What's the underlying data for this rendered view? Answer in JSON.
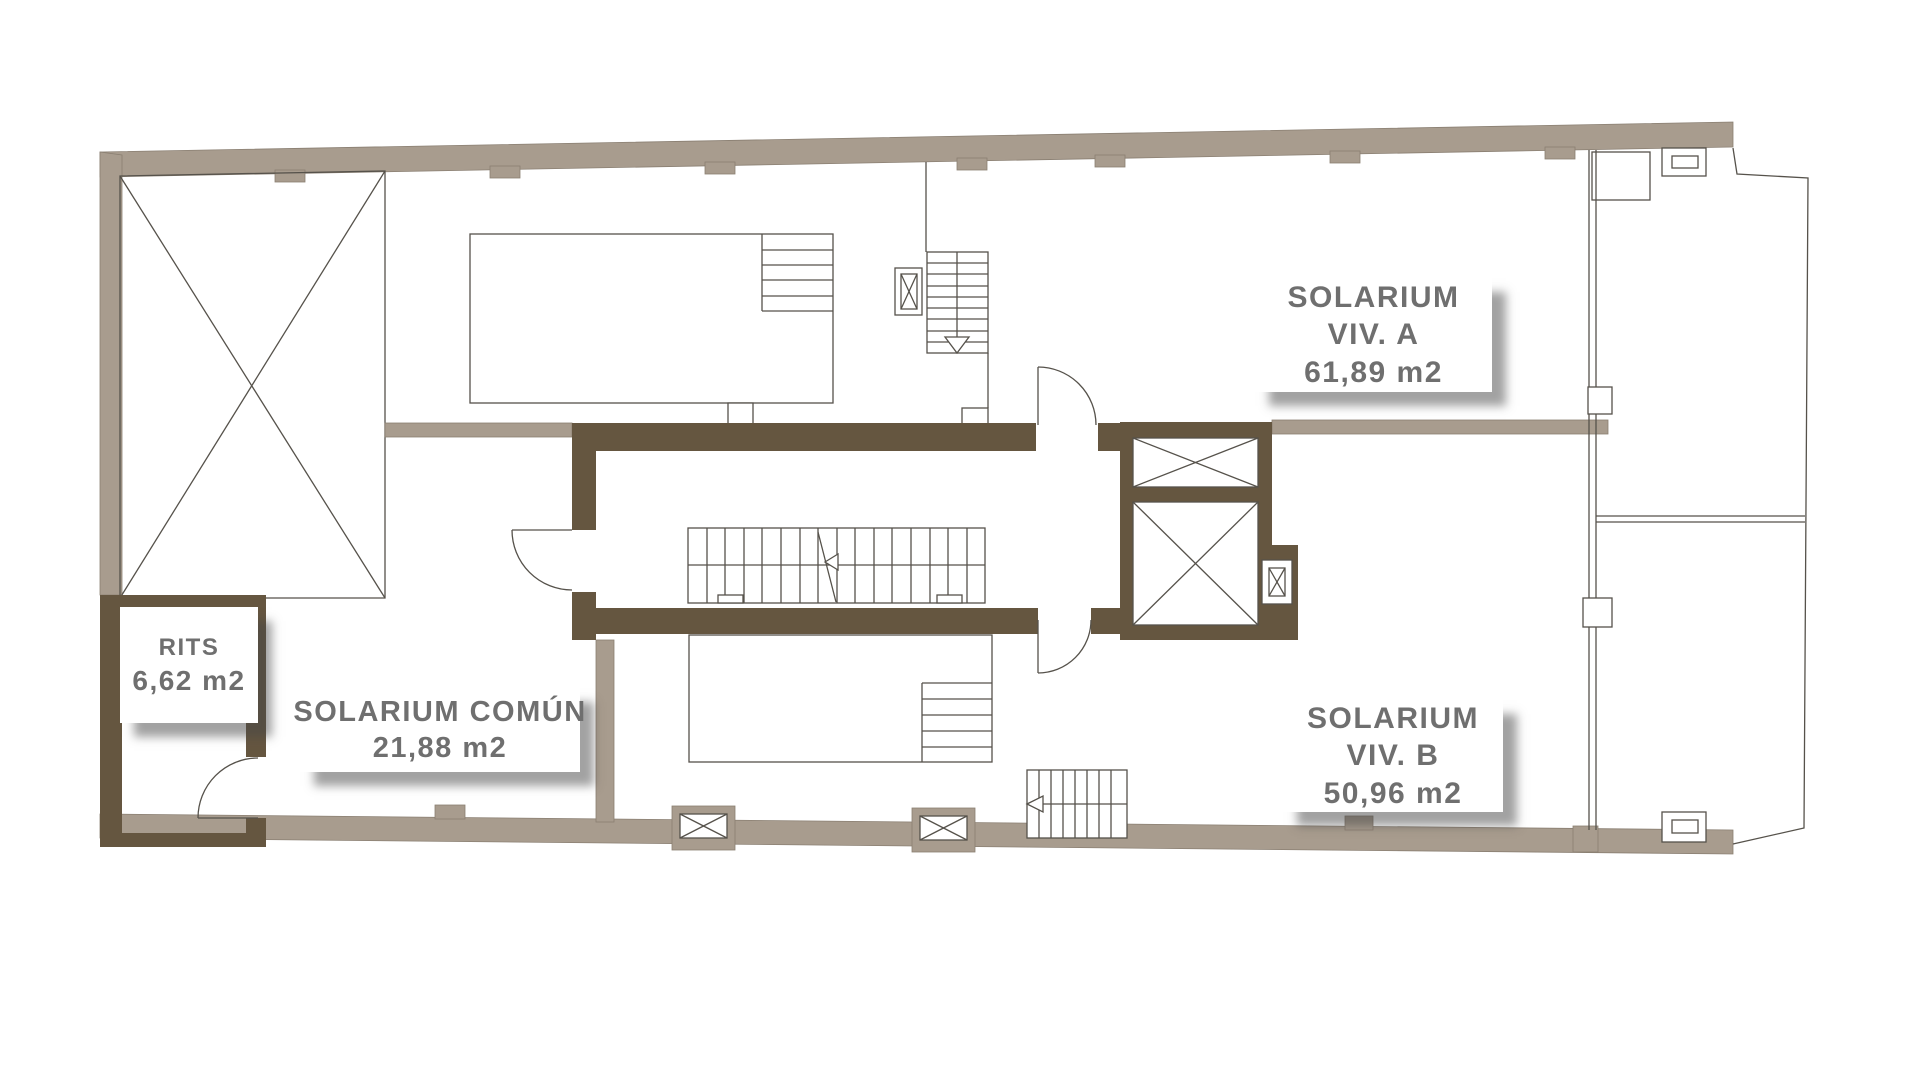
{
  "rooms": {
    "rits": {
      "name": "RITS",
      "area": "6,62 m2"
    },
    "solarium_comun": {
      "name": "SOLARIUM COMÚN",
      "area": "21,88 m2"
    },
    "solarium_viv_a": {
      "name": "SOLARIUM",
      "unit": "VIV. A",
      "area": "61,89 m2"
    },
    "solarium_viv_b": {
      "name": "SOLARIUM",
      "unit": "VIV. B",
      "area": "50,96 m2"
    }
  },
  "colors": {
    "exterior_wall": "#a89c8e",
    "core_wall": "#655640",
    "line": "#56524b",
    "label_text": "#6f6f6f",
    "background": "#ffffff"
  }
}
